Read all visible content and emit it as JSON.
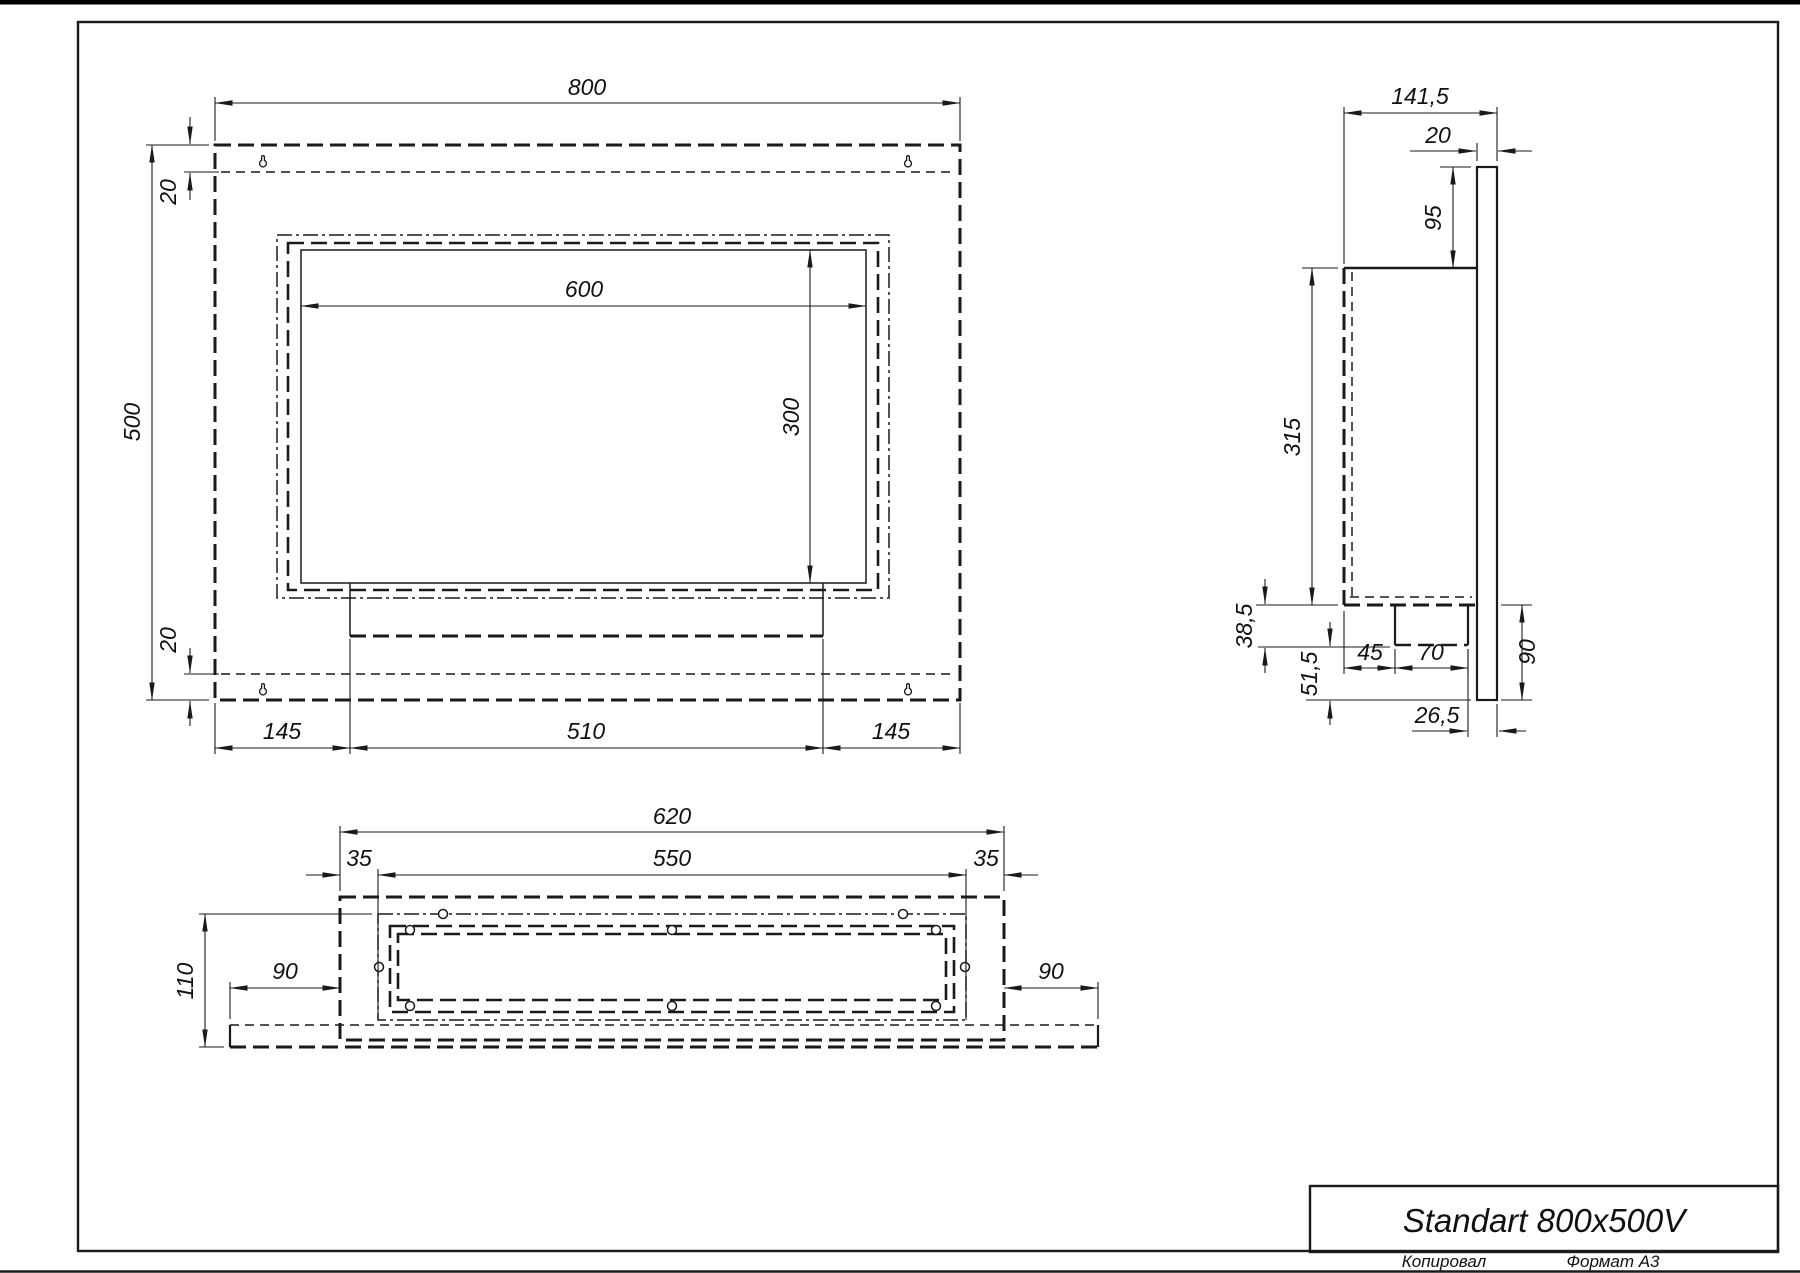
{
  "title_block": {
    "title": "Standart 800x500V",
    "copied_label": "Копировал",
    "format_label": "Формат A3"
  },
  "front_view": {
    "dims": {
      "overall_width": "800",
      "overall_height": "500",
      "top_flange": "20",
      "bottom_flange": "20",
      "opening_width": "600",
      "opening_height": "300",
      "bottom_left": "145",
      "burner_width": "510",
      "bottom_right": "145"
    }
  },
  "side_view": {
    "dims": {
      "overall_depth": "141,5",
      "plate_thickness": "20",
      "top_to_box": "95",
      "box_height": "315",
      "tray_drop": "38,5",
      "lower_flange": "51,5",
      "tray_inset": "45",
      "tray_width": "70",
      "flange_height": "90",
      "back_gap": "26,5"
    }
  },
  "bottom_view": {
    "dims": {
      "box_width": "620",
      "margin_left": "35",
      "opening_width": "550",
      "margin_right": "35",
      "depth": "110",
      "flange_left": "90",
      "flange_right": "90"
    }
  },
  "colors": {
    "line": "#1a1a1a",
    "background": "#ffffff"
  }
}
